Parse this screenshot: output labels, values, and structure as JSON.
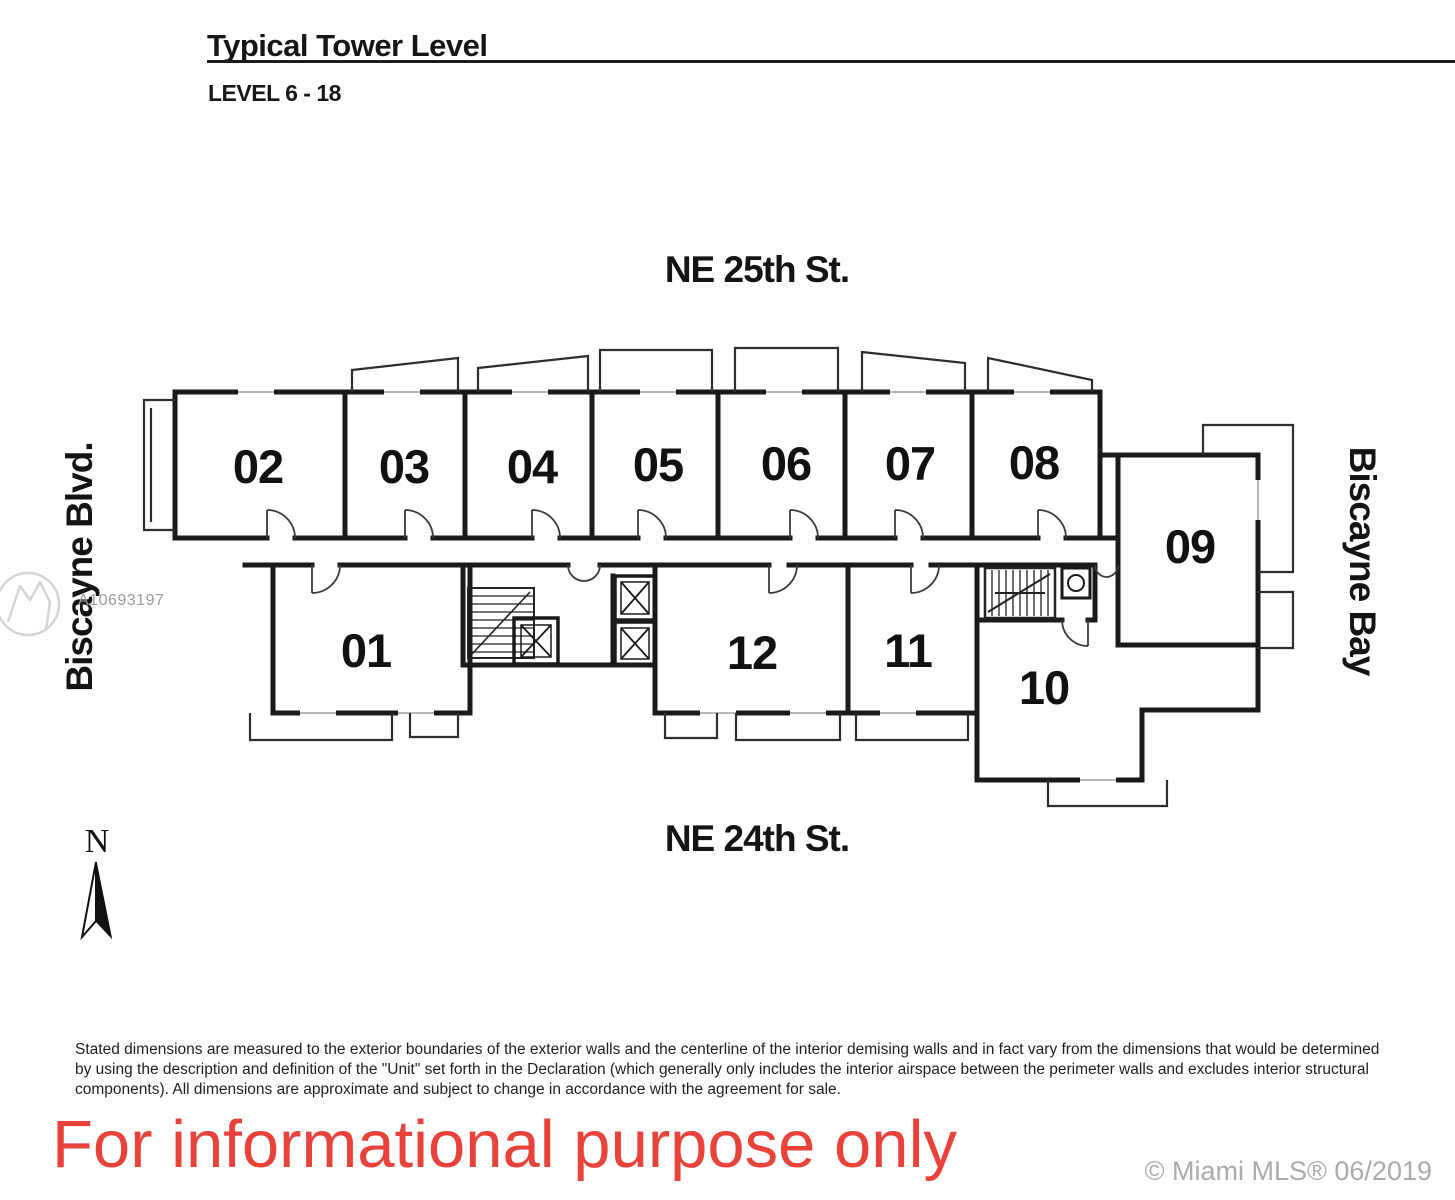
{
  "document": {
    "title": "Typical Tower Level",
    "subtitle": "LEVEL 6 - 18"
  },
  "streets": {
    "north": "NE 25th St.",
    "south": "NE 24th St.",
    "west": "Biscayne Blvd.",
    "east": "Biscayne Bay"
  },
  "compass": {
    "north_label": "N"
  },
  "plan": {
    "units": [
      "01",
      "02",
      "03",
      "04",
      "05",
      "06",
      "07",
      "08",
      "09",
      "10",
      "11",
      "12"
    ]
  },
  "watermark": {
    "listing_id": "A10693197"
  },
  "footer": {
    "disclaimer": "Stated dimensions are measured to the exterior boundaries of the exterior walls and the centerline of the interior demising walls and in fact vary from the dimensions that would be determined by using the description and definition of the \"Unit\" set forth in the Declaration (which generally only includes the interior airspace between the perimeter walls and excludes interior structural components). All dimensions are approximate and subject to change in accordance with the agreement for sale.",
    "notice": "For informational purpose only",
    "credit": "© Miami MLS® 06/2019"
  },
  "colors": {
    "wall": "#1a1a1a",
    "notice_red": "#e8423a",
    "watermark_gray": "#9b9b9b",
    "credit_gray": "#ababab"
  }
}
